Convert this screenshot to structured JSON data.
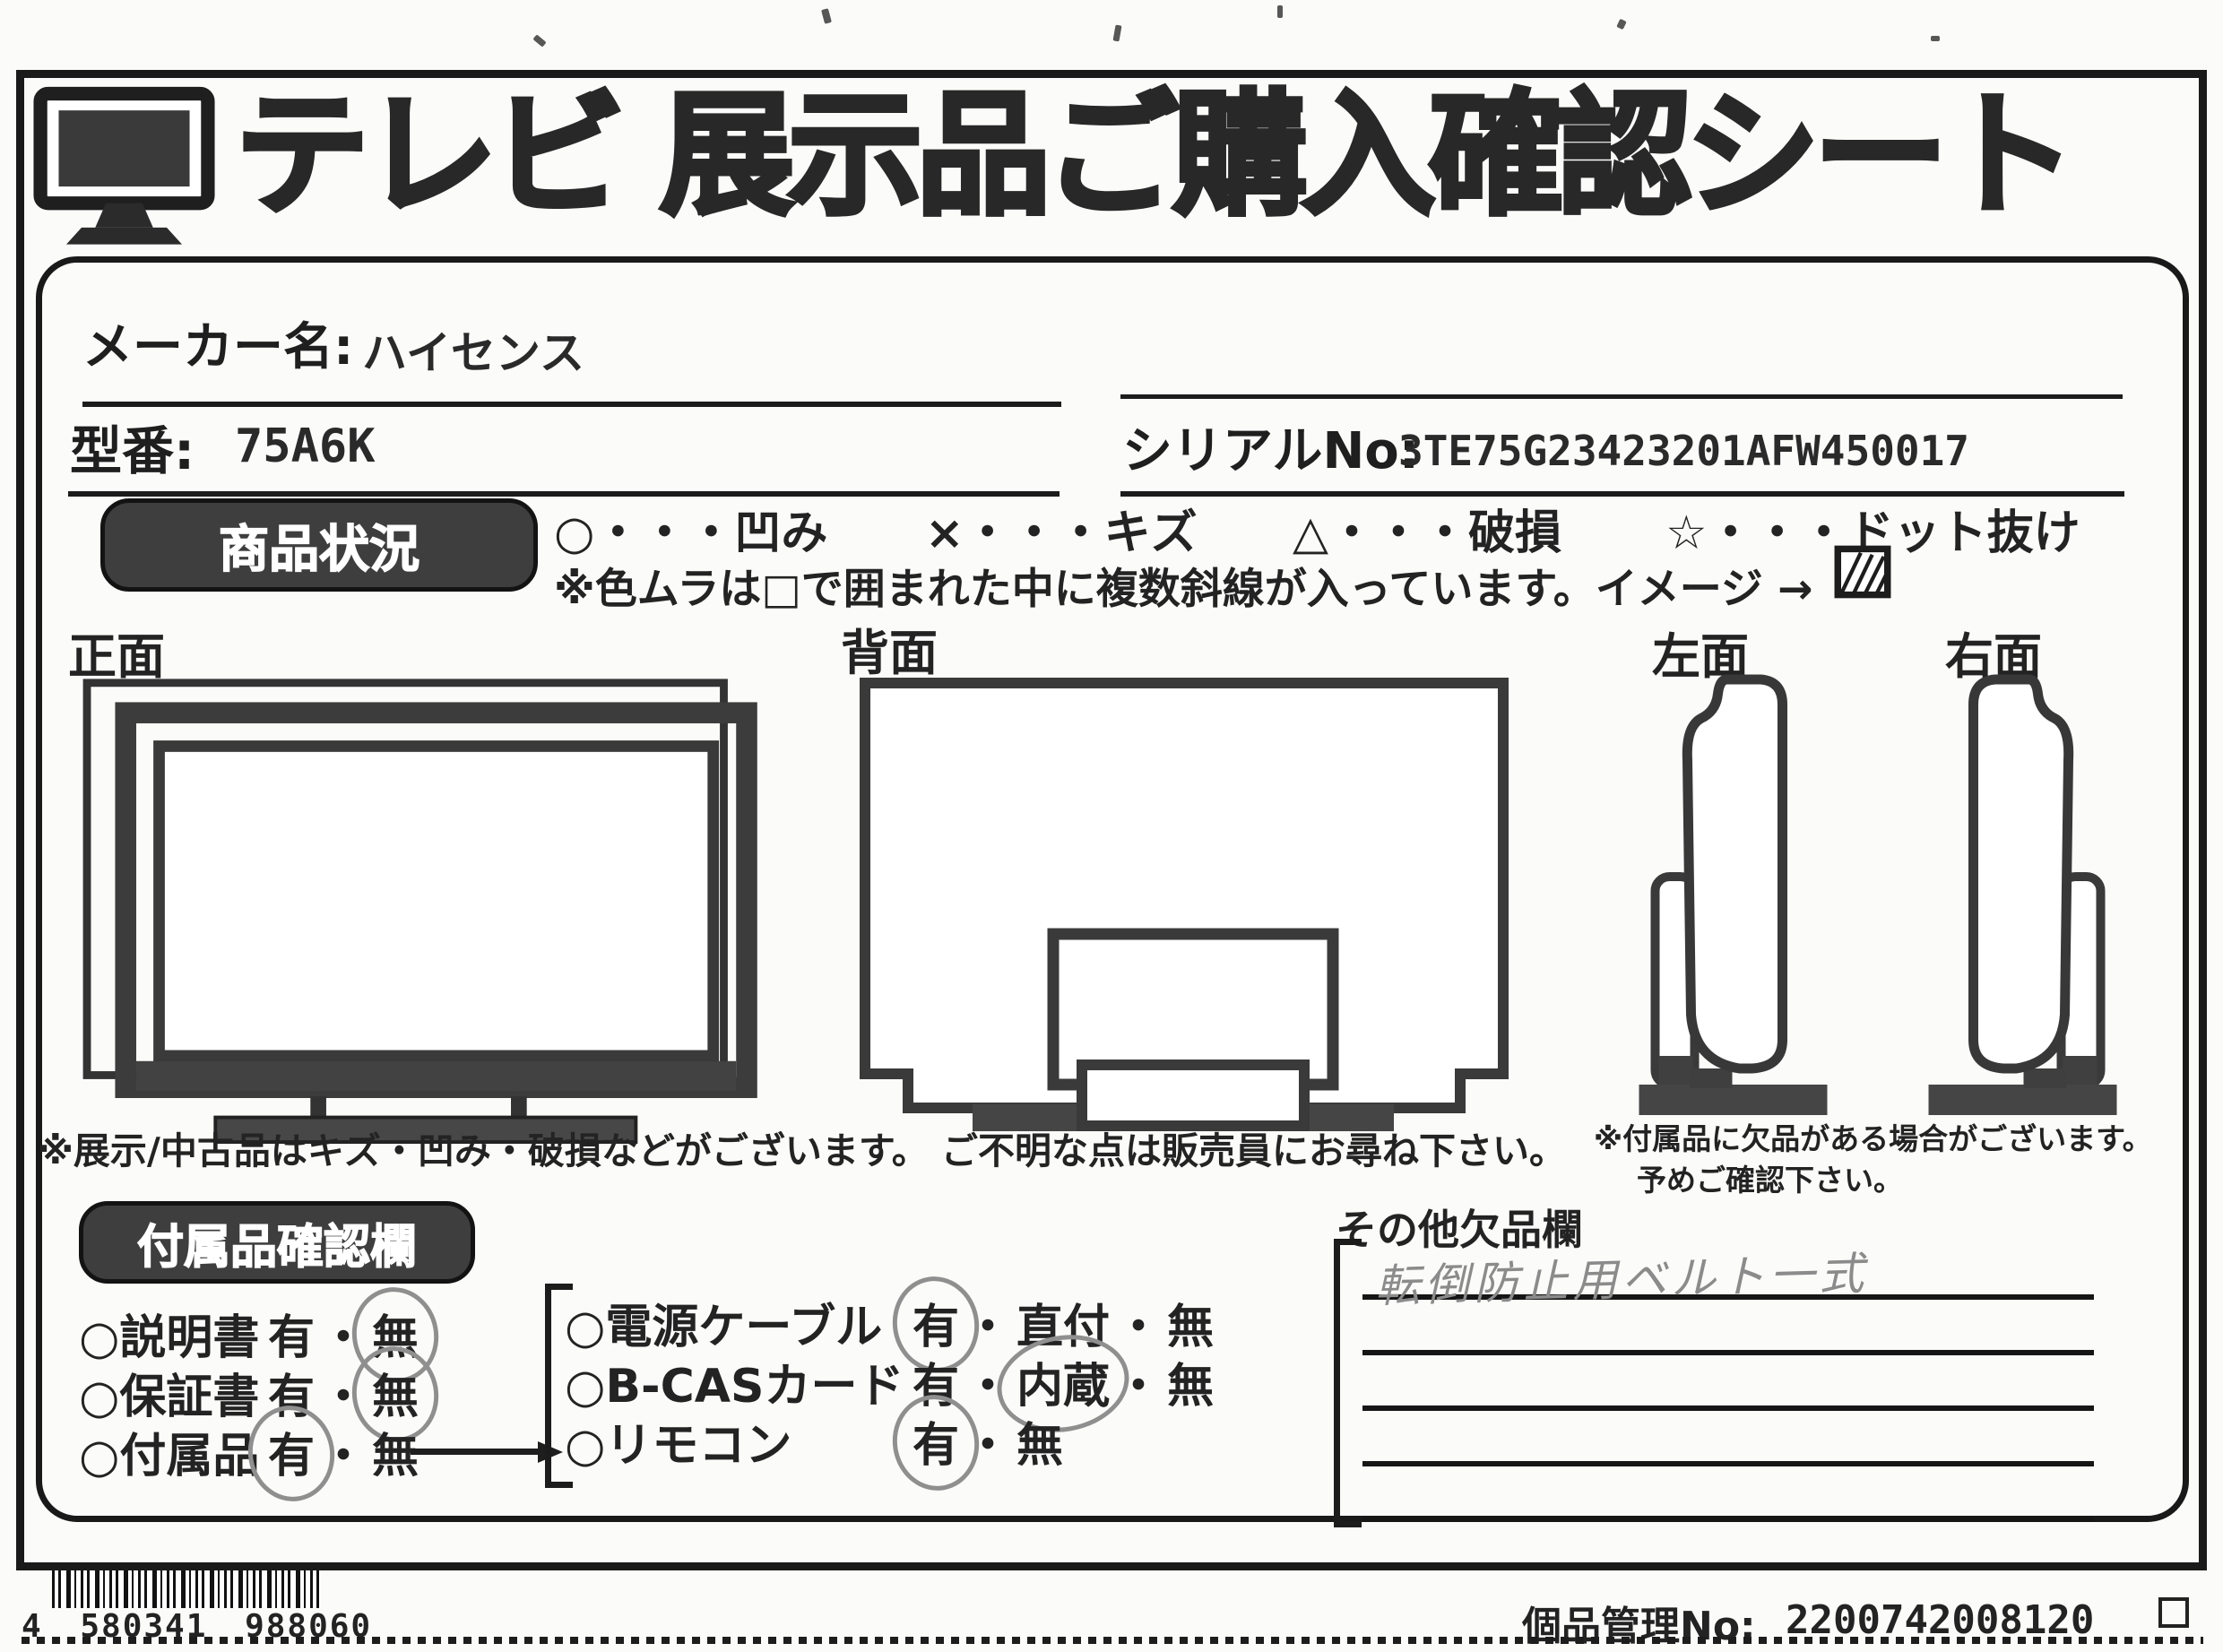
{
  "header": {
    "title": "テレビ 展示品ご購入確認シート"
  },
  "fields": {
    "maker_label": "メーカー名:",
    "maker_value": "ハイセンス",
    "model_label": "型番:",
    "model_value": "75A6K",
    "serial_label": "シリアルNo:",
    "serial_value": "3TE75G23423201AFW450017"
  },
  "condition": {
    "section_label": "商品状況",
    "legend": [
      "○・・・凹み",
      "×・・・キズ",
      "△・・・破損",
      "☆・・・ドット抜け"
    ],
    "color_note": "※色ムラは□で囲まれた中に複数斜線が入っています。イメージ →",
    "view_labels": [
      "正面",
      "背面",
      "左面",
      "右面"
    ]
  },
  "notes": {
    "main": "※展示/中古品はキズ・凹み・破損などがございます。 ご不明な点は販売員にお尋ね下さい。",
    "accessory_line1": "※付属品に欠品がある場合がございます。",
    "accessory_line2": "予めご確認下さい。"
  },
  "accessories": {
    "section_label": "付属品確認欄",
    "separator": "・",
    "left_items": [
      {
        "name": "○説明書",
        "options": [
          "有",
          "無"
        ],
        "selected": "無"
      },
      {
        "name": "○保証書",
        "options": [
          "有",
          "無"
        ],
        "selected": "無"
      },
      {
        "name": "○付属品",
        "options": [
          "有",
          "無"
        ],
        "selected": "有"
      }
    ],
    "right_items": [
      {
        "name": "○電源ケーブル",
        "options": [
          "有",
          "直付",
          "無"
        ],
        "selected": "有"
      },
      {
        "name": "○B-CASカード",
        "options": [
          "有",
          "内蔵",
          "無"
        ],
        "selected": "内蔵"
      },
      {
        "name": "○リモコン",
        "options": [
          "有",
          "無"
        ],
        "selected": "有"
      }
    ]
  },
  "missing": {
    "section_label": "その他欠品欄",
    "handwritten": "転倒防止用ベルト一式",
    "line_count": 5
  },
  "footer": {
    "barcode_text": "4 580341 988060",
    "management_label": "個品管理No:",
    "management_value": "2200742008120"
  },
  "colors": {
    "ink": "#1c1c1c",
    "paper": "#fbfbfa",
    "pencil": "#8b8b8b",
    "fill_dark": "#454545"
  }
}
